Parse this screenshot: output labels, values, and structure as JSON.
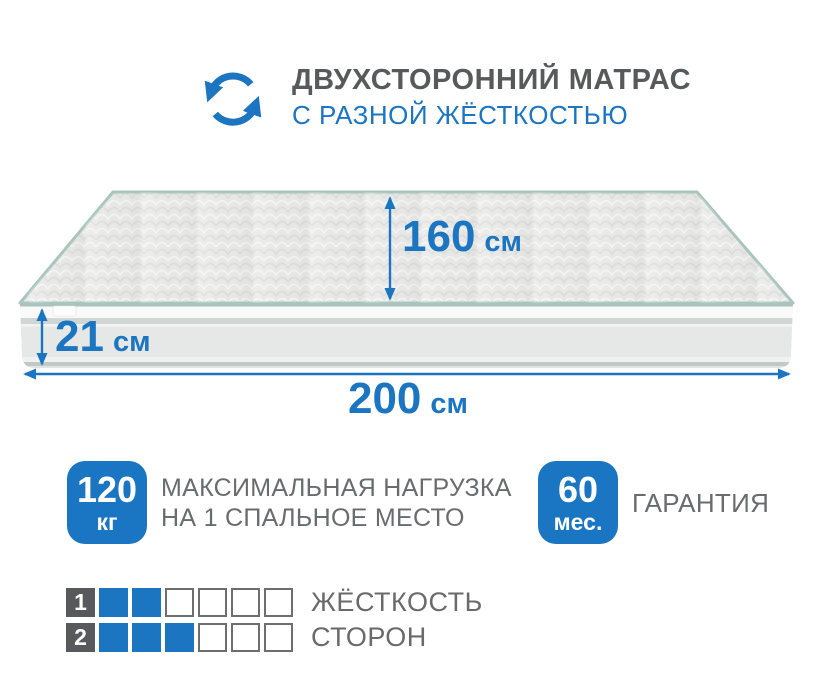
{
  "header": {
    "title": "ДВУХСТОРОННИЙ МАТРАС",
    "subtitle": "С РАЗНОЙ ЖЁСТКОСТЬЮ",
    "icon": "two-sided-rotation-icon"
  },
  "dimensions": {
    "depth": {
      "value": "160",
      "unit": "см"
    },
    "height": {
      "value": "21",
      "unit": "см"
    },
    "length": {
      "value": "200",
      "unit": "см"
    }
  },
  "features": {
    "max_load": {
      "badge_value": "120",
      "badge_unit": "кг",
      "label_line1": "МАКСИМАЛЬНАЯ НАГРУЗКА",
      "label_line2": "НА 1 СПАЛЬНОЕ МЕСТО"
    },
    "warranty": {
      "badge_value": "60",
      "badge_unit": "мес.",
      "label": "ГАРАНТИЯ"
    }
  },
  "firmness": {
    "rows": [
      {
        "label": "1",
        "filled": 2,
        "total": 6,
        "caption": "ЖЁСТКОСТЬ"
      },
      {
        "label": "2",
        "filled": 3,
        "total": 6,
        "caption": "СТОРОН"
      }
    ]
  },
  "theme": {
    "accent_blue": "#1B75C1",
    "badge_blue": "#1A75C2",
    "title_gray": "#58595B",
    "text_gray": "#6A6B6D",
    "square_border": "#6E6E6E",
    "label_square_gray": "#58595C",
    "piping_teal": "#A9C4BE",
    "mattress_light": "#E7E8E6"
  }
}
